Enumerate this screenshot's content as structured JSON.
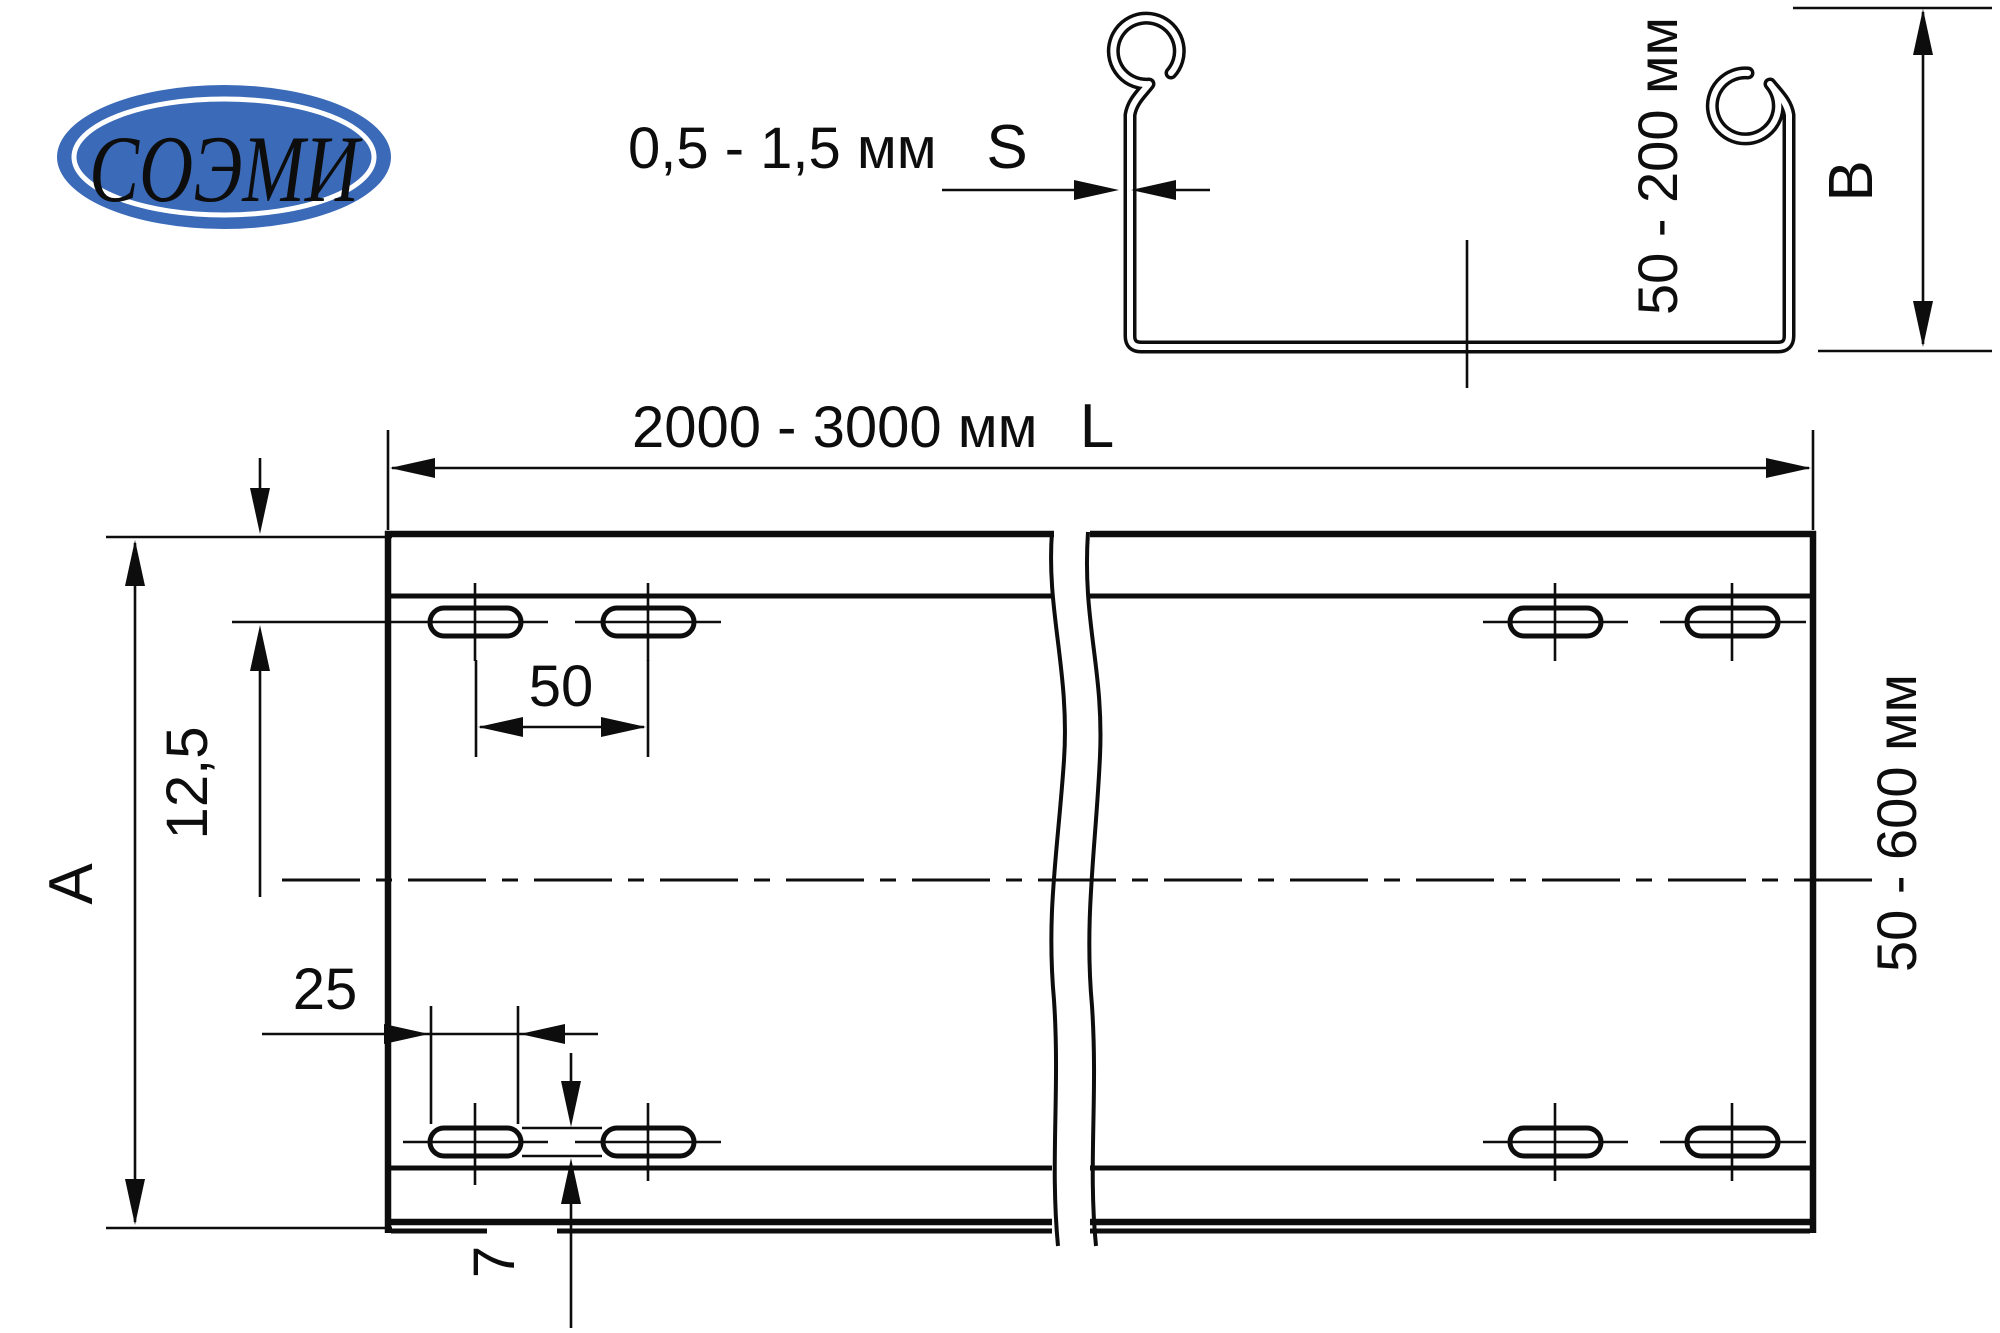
{
  "colors": {
    "background": "#ffffff",
    "ink": "#0d0d0d",
    "logo_blue": "#3a6ab8",
    "logo_text_color": "#ffffff"
  },
  "logo": {
    "text": "СОЭМИ"
  },
  "cross_section_view": {
    "thickness_range": "0,5 - 1,5 мм",
    "thickness_symbol": "S",
    "height_range": "50 - 200 мм",
    "height_symbol": "B"
  },
  "plan_view": {
    "length_range": "2000 - 3000 мм",
    "length_symbol": "L",
    "width_range": "50 - 600 мм",
    "width_symbol": "A",
    "dim_edge_to_slot_row": "12,5",
    "dim_slot_pitch": "50",
    "dim_slot_length": "25",
    "dim_slot_width": "7"
  }
}
